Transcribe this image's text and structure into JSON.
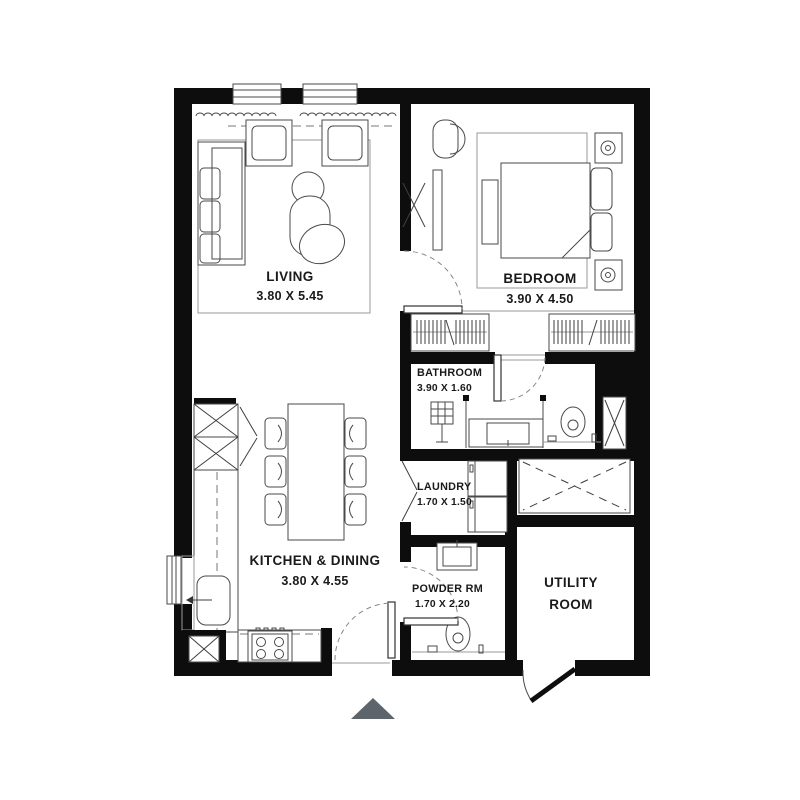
{
  "colors": {
    "background": "#ffffff",
    "wall": "#0d0d0d",
    "furniture_line": "#4a4a4a",
    "light_line": "#9a9a9a",
    "text": "#1a1a1a",
    "entrance_arrow": "#5d656c"
  },
  "rooms": [
    {
      "name": "LIVING",
      "dimensions": "3.80 X 5.45"
    },
    {
      "name": "BEDROOM",
      "dimensions": "3.90 X 4.50"
    },
    {
      "name": "BATHROOM",
      "dimensions": "3.90 X 1.60"
    },
    {
      "name": "LAUNDRY",
      "dimensions": "1.70 X 1.50"
    },
    {
      "name": "KITCHEN & DINING",
      "dimensions": "3.80 X 4.55"
    },
    {
      "name": "POWDER RM",
      "dimensions": "1.70 X 2.20"
    },
    {
      "name": "UTILITY ROOM",
      "name_lines": [
        "UTILITY",
        "ROOM"
      ]
    }
  ]
}
